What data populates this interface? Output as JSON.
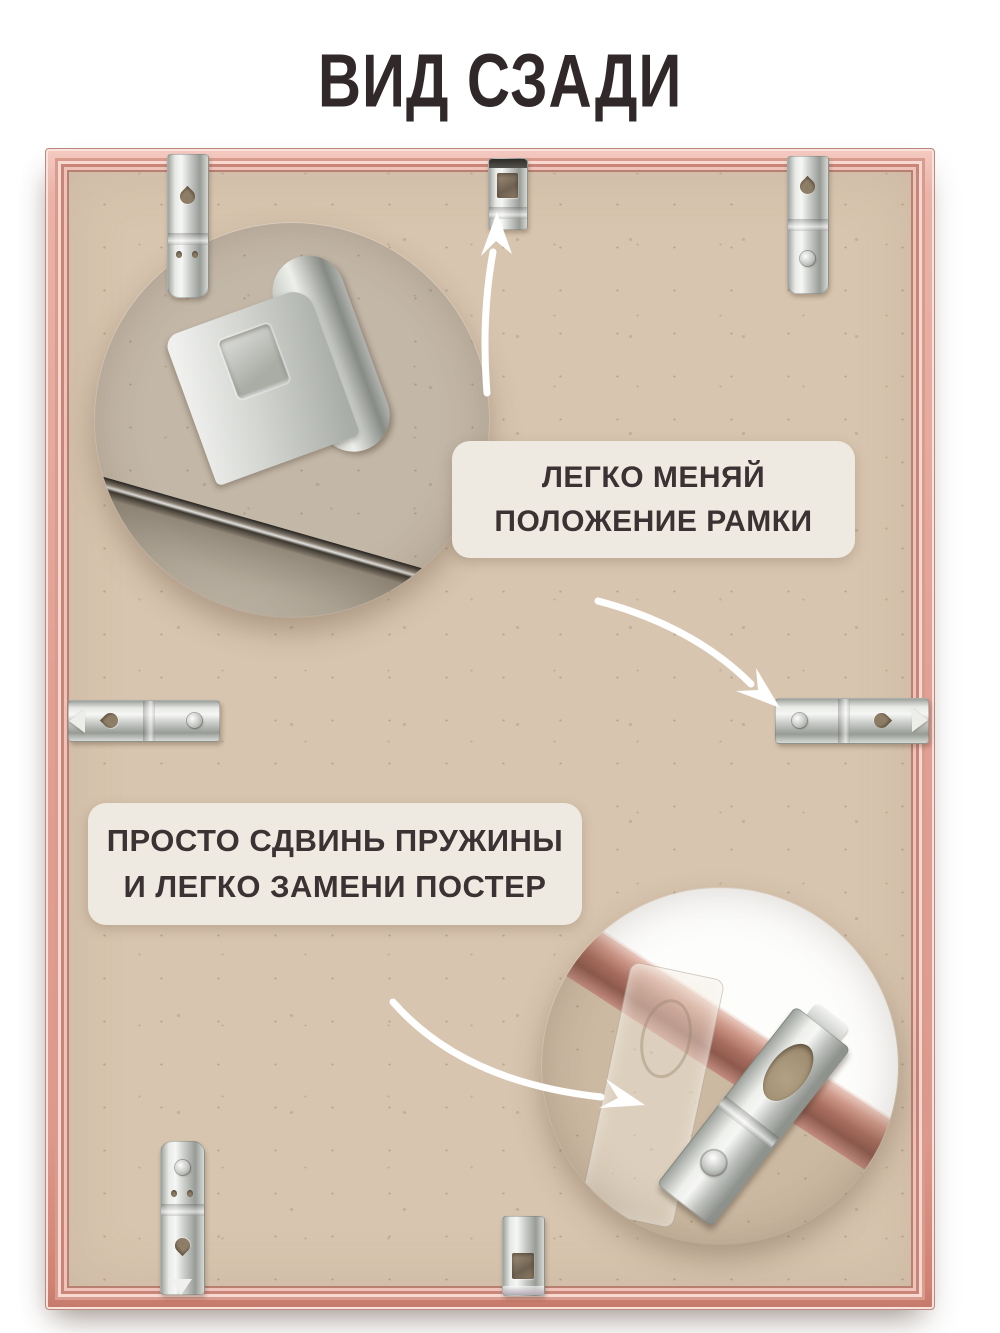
{
  "title": "ВИД СЗАДИ",
  "annotations": {
    "frame_position": {
      "line1": "ЛЕГКО МЕНЯЙ",
      "line2": "ПОЛОЖЕНИЕ РАМКИ"
    },
    "replace_poster": {
      "line1": "ПРОСТО СДВИНЬ ПРУЖИНЫ",
      "line2": "И ЛЕГКО ЗАМЕНИ ПОСТЕР"
    }
  },
  "icons": {
    "arrow_to_top_clip": "curved-white-arrow-up",
    "arrow_to_right_bracket": "curved-white-arrow-down-right",
    "arrow_to_bottom_inset": "curved-white-arrow-right"
  },
  "colors": {
    "page_bg": "#ffffff",
    "title_text": "#31282a",
    "frame_rose_gold": "#e2a195",
    "frame_copper_line": "#bd7a6c",
    "mdf_board": "#d8c5af",
    "inset_circle_top": "#c3b7a7",
    "inset_circle_bottom": "#cbb9a2",
    "annotation_bg": "#efeae1",
    "annotation_text": "#3b3234",
    "metal_clip": "#cdd0cc",
    "arrow": "#ffffff"
  }
}
